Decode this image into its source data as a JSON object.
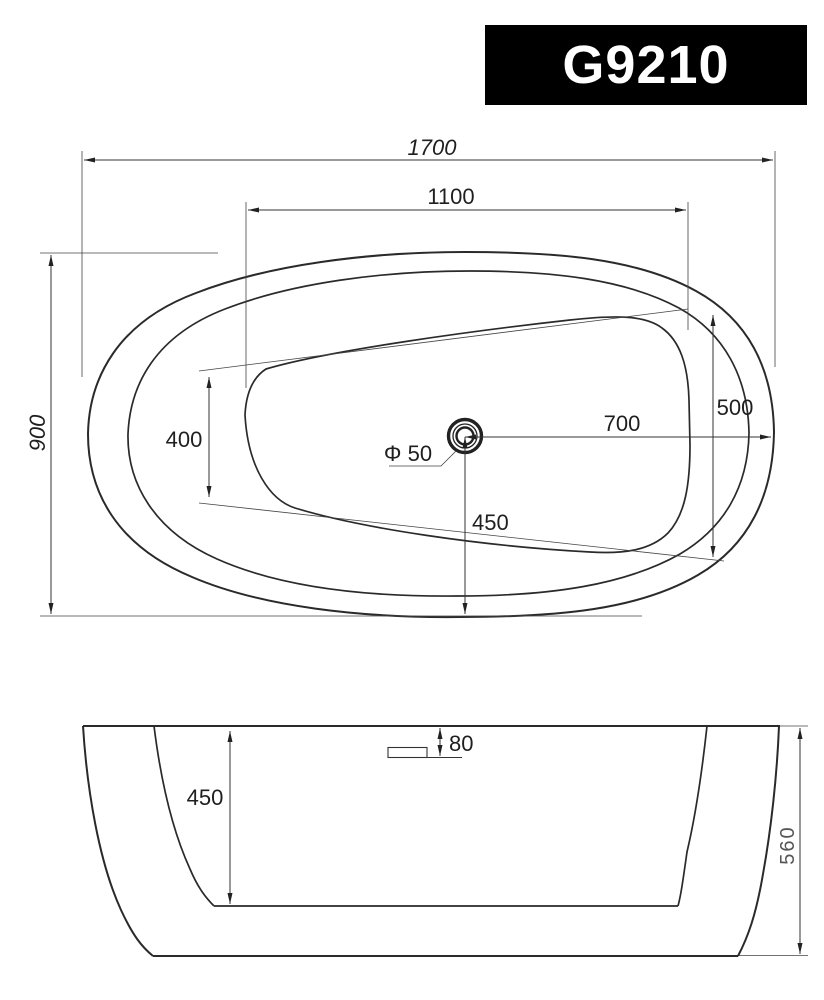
{
  "title_block": {
    "model": "G9210"
  },
  "top_view": {
    "dimensions": {
      "overall_length": "1700",
      "basin_length": "1100",
      "overall_width": "900",
      "basin_width_left": "400",
      "basin_width_right": "500",
      "drain_to_right_edge": "700",
      "drain_to_bottom_edge": "450",
      "drain_diameter": "Φ 50"
    }
  },
  "side_view": {
    "dimensions": {
      "basin_depth": "450",
      "overflow_offset": "80",
      "overall_height": "560"
    }
  },
  "colors": {
    "background": "#ffffff",
    "line": "#2a2a2a",
    "title_bg": "#000000",
    "title_fg": "#ffffff"
  }
}
